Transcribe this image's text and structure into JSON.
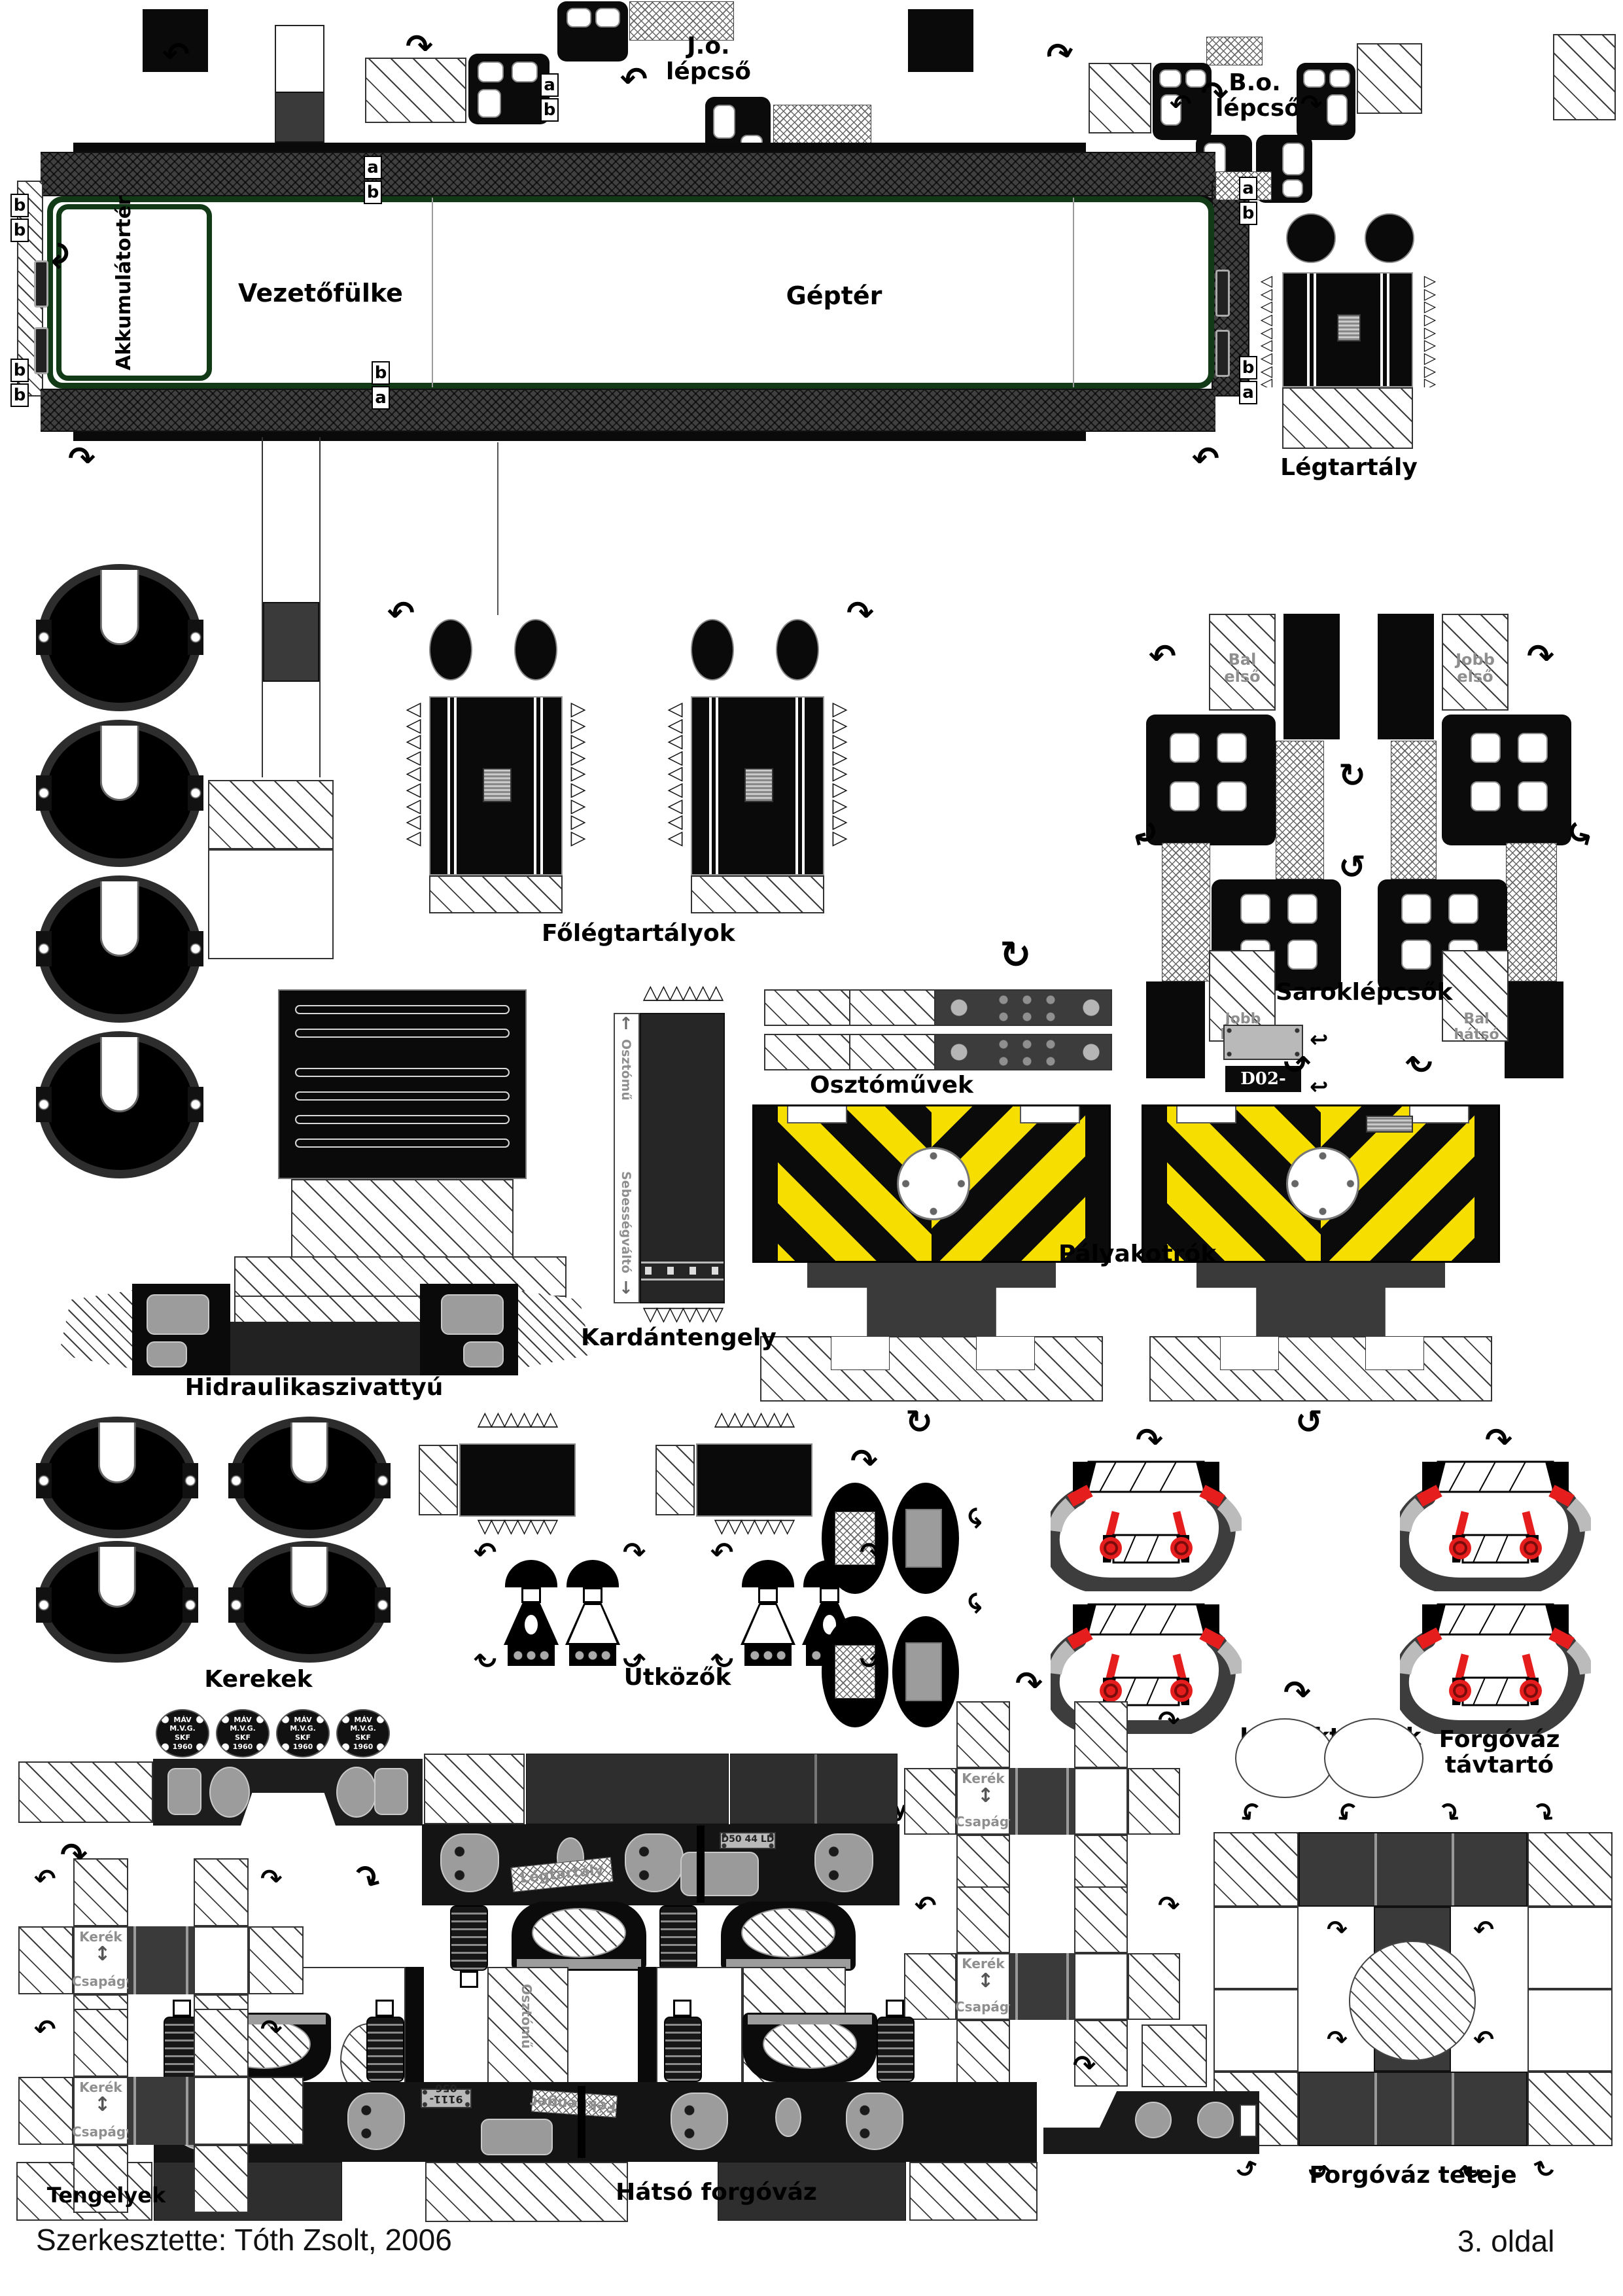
{
  "labels": {
    "jo_lepcso": "J.o.\nlépcső",
    "bo_lepcso": "B.o.\nlépcső",
    "akkumulatorter": "Akkumulátortér",
    "vezetofulke": "Vezetőfülke",
    "gepter": "Géptér",
    "legtartaly": "Légtartály",
    "folegtartalyok": "Főlégtartályok",
    "saroklepcsok": "Saroklépcsők",
    "bal_elso": "Bal első",
    "jobb_elso": "Jobb első",
    "jobb_hatso": "Jobb hátsó",
    "bal_hatso": "Bal hátsó",
    "osztomuvek": "Osztóművek",
    "plate_number": "D02-501",
    "palyakotrok": "Pályakotrók",
    "hidraulikaszivattyu": "Hidraulikaszivattyú",
    "kardantengely": "Kardántengely",
    "osztomu": "Osztómű",
    "sebessegvalto": "Sebességváltó",
    "kerekek": "Kerekek",
    "utkozok": "Ütközők",
    "legfektomlok": "Légféktömlők",
    "forgovaz_tavtarto": "Forgóváz\ntávtartó",
    "tengelyek": "Tengelyek",
    "hatso_forgovaz": "Hátsó forgóváz",
    "forgovaz_teteje": "Forgóváz teteje",
    "kerek": "Kerék",
    "csapagy": "Csapágy",
    "fekhenger": "Fékhenger",
    "bogie_plate": "9111-056",
    "axle_plate": "D50 44 LD"
  },
  "badge": {
    "text": "MÁV\nM.V.G.\nSKF\n1960"
  },
  "tabs": {
    "a": "a",
    "b": "b"
  },
  "icons": {
    "arrow_cw": "↷",
    "arrow_ccw": "↶",
    "rot_cw": "↻",
    "rot_ccw": "↺",
    "updown": "↕",
    "hook": "↩",
    "up": "↑",
    "down": "↓",
    "spikes_up": "△△△△△△",
    "spikes_down": "▽▽▽▽▽▽",
    "spikes_left": "◁\n◁\n◁\n◁\n◁\n◁\n◁\n◁\n◁",
    "spikes_right": "▷\n▷\n▷\n▷\n▷\n▷\n▷\n▷\n▷"
  },
  "colors": {
    "warning_yellow": "#f6df00",
    "hose_red": "#e51d1d",
    "frame_green": "#123a17"
  },
  "footer": {
    "author": "Szerkesztette: Tóth Zsolt, 2006",
    "page": "3. oldal"
  }
}
